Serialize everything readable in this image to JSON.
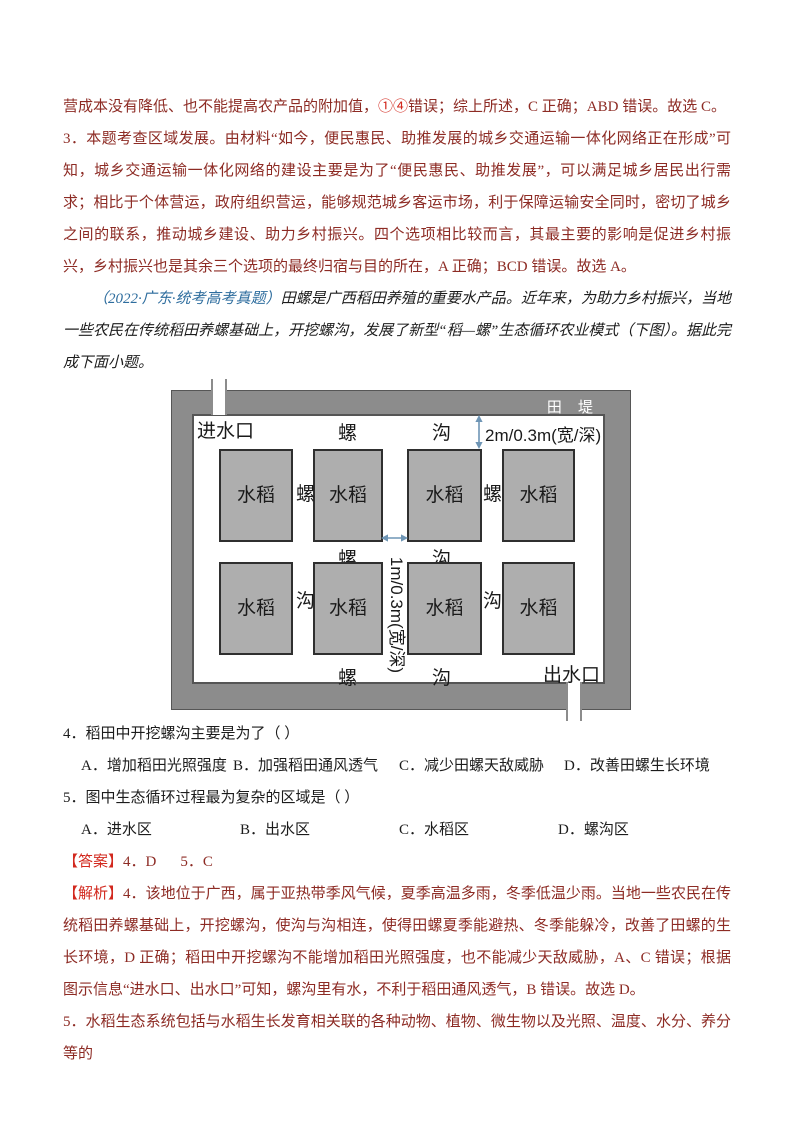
{
  "colors": {
    "body_dark_red": "#8d2b24",
    "label_bright_red": "#d2281e",
    "source_blue": "#2e6d9e",
    "question_black": "#1a1a1a",
    "dike_band_gray": "#8c8c8c",
    "plot_fill_gray": "#aeaeae",
    "plot_border": "#2f2f2f",
    "arrow_blue": "#6e95b5"
  },
  "intro": {
    "p1_pre": "营成本没有降低、也不能提高农产品的附加值，",
    "p1_circled": "①④",
    "p1_post": "错误；综上所述，C 正确；ABD 错误。故选 C。",
    "p2": "3．本题考查区域发展。由材料“如今，便民惠民、助推发展的城乡交通运输一体化网络正在形成”可知，城乡交通运输一体化网络的建设主要是为了“便民惠民、助推发展”，可以满足城乡居民出行需求；相比于个体营运，政府组织营运，能够规范城乡客运市场，利于保障运输安全同时，密切了城乡之间的联系，推动城乡建设、助力乡村振兴。四个选项相比较而言，其最主要的影响是促进乡村振兴，乡村振兴也是其余三个选项的最终归宿与目的所在，A 正确；BCD 错误。故选 A。"
  },
  "material": {
    "source": "（2022·广东·统考高考真题）",
    "text": "田螺是广西稻田养殖的重要水产品。近年来，为助力乡村振兴，当地一些农民在传统稻田养螺基础上，开挖螺沟，发展了新型“稻—螺”生态循环农业模式（下图）。据此完成下面小题。"
  },
  "diagram": {
    "dike": "田 堤",
    "inlet": "进水口",
    "outlet": "出水口",
    "snail": "螺",
    "ditch": "沟",
    "rice": "水稻",
    "dim_top": "2m/0.3m(宽/深)",
    "dim_mid": "1m/0.3m(宽/深)"
  },
  "q4": {
    "stem": "4．稻田中开挖螺沟主要是为了（  ）",
    "options": [
      "A．增加稻田光照强度",
      "B．加强稻田通风透气",
      "C．减少田螺天敌威胁",
      "D．改善田螺生长环境"
    ]
  },
  "q5": {
    "stem": "5．图中生态循环过程最为复杂的区域是（  ）",
    "options": [
      "A．进水区",
      "B．出水区",
      "C．水稻区",
      "D．螺沟区"
    ]
  },
  "answer": {
    "label": "【答案】",
    "a4": "4．D",
    "a5": "5．C"
  },
  "analysis": {
    "label": "【解析】",
    "p4": "4．该地位于广西，属于亚热带季风气候，夏季高温多雨，冬季低温少雨。当地一些农民在传统稻田养螺基础上，开挖螺沟，使沟与沟相连，使得田螺夏季能避热、冬季能躲冷，改善了田螺的生长环境，D 正确；稻田中开挖螺沟不能增加稻田光照强度，也不能减少天敌威胁，A、C 错误；根据图示信息“进水口、出水口”可知，螺沟里有水，不利于稻田通风透气，B 错误。故选 D。",
    "p5": "5．水稻生态系统包括与水稻生长发育相关联的各种动物、植物、微生物以及光照、温度、水分、养分等的"
  }
}
